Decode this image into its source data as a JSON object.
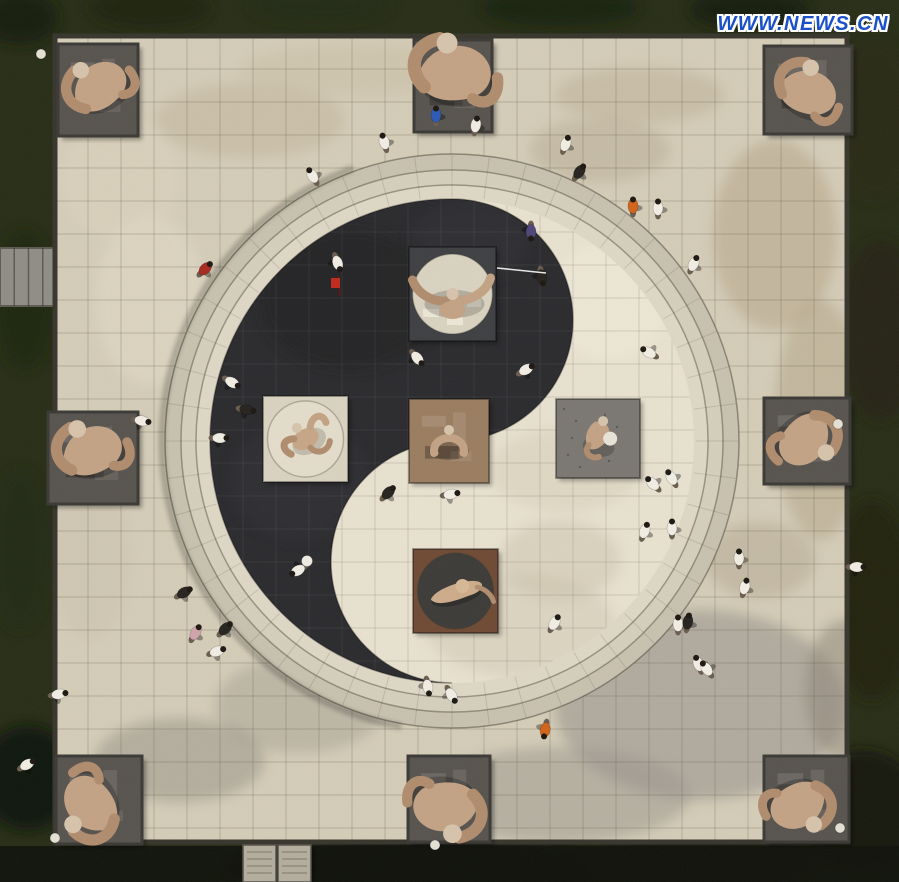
{
  "meta": {
    "description": "Aerial photo of a taiji (yin-yang) sculpture plaza with tai-chi themed stone sculptures and visitors",
    "watermark": "WWW.NEWS.CN"
  },
  "canvas": {
    "width": 899,
    "height": 882
  },
  "palette": {
    "grass_base": "#272d16",
    "grass_bottom": "#0f120a",
    "plaza_base": "#d4ccb7",
    "grid_line": "rgba(95,85,68,0.28)",
    "plaza_frame": "#37352c",
    "ring_outer": "#c8c1af",
    "ring_mid": "#d5cebc",
    "ring_inner": "#ded7c5",
    "yin": "#2a2a2d",
    "yang": "#e8e1cf",
    "base_outer": "#57534e",
    "base_outer_border": "#3b3935",
    "sculpt_tan": "#c3a284",
    "sculpt_tan_dark": "#b08c6d",
    "sculpt_head": "#d6c3ab",
    "path_stone": "#8f8d85",
    "stele_stone": "#b4ad9d",
    "watermark_blue": "#1a51c9",
    "shirts": {
      "white": "#f1ede3",
      "black": "#26231e",
      "blue": "#2d59b5",
      "orange": "#d26318",
      "red": "#a8281e",
      "pink": "#d0a4ab",
      "purple": "#4f4579"
    }
  },
  "scene": {
    "plaza": {
      "x": 55,
      "y": 36,
      "w": 792,
      "h": 806,
      "tile": 33
    },
    "circle": {
      "cx": 452,
      "cy": 441,
      "r_rings": [
        287,
        271,
        256,
        242
      ],
      "r_eye": 121
    },
    "left_path": {
      "x": 0,
      "y": 248,
      "w": 57,
      "h": 58
    },
    "stele": {
      "x": 243,
      "y": 845,
      "w": 68,
      "h": 37
    },
    "grass_blobs": [
      {
        "x": 20,
        "y": 18,
        "rx": 38,
        "ry": 26,
        "c": "#161d0c",
        "o": 0.9
      },
      {
        "x": 150,
        "y": 8,
        "rx": 60,
        "ry": 20,
        "c": "#1a220e",
        "o": 0.8
      },
      {
        "x": 320,
        "y": 6,
        "rx": 70,
        "ry": 16,
        "c": "#202a12",
        "o": 0.8
      },
      {
        "x": 560,
        "y": 8,
        "rx": 80,
        "ry": 18,
        "c": "#18200d",
        "o": 0.85
      },
      {
        "x": 750,
        "y": 10,
        "rx": 60,
        "ry": 20,
        "c": "#141b0a",
        "o": 0.9
      },
      {
        "x": 875,
        "y": 120,
        "rx": 42,
        "ry": 80,
        "c": "#2a2a18",
        "o": 0.8
      },
      {
        "x": 880,
        "y": 330,
        "rx": 38,
        "ry": 90,
        "c": "#262417",
        "o": 0.8
      },
      {
        "x": 872,
        "y": 600,
        "rx": 42,
        "ry": 100,
        "c": "#20200f",
        "o": 0.85
      },
      {
        "x": 862,
        "y": 810,
        "rx": 62,
        "ry": 60,
        "c": "#12150a",
        "o": 0.9
      },
      {
        "x": 25,
        "y": 300,
        "rx": 30,
        "ry": 70,
        "c": "#1e2511",
        "o": 0.8
      },
      {
        "x": 20,
        "y": 550,
        "rx": 30,
        "ry": 80,
        "c": "#222a13",
        "o": 0.8
      },
      {
        "x": 28,
        "y": 778,
        "rx": 48,
        "ry": 52,
        "c": "#0e1208",
        "o": 0.95
      },
      {
        "x": 420,
        "y": 868,
        "rx": 200,
        "ry": 30,
        "c": "#0d1008",
        "o": 0.9
      },
      {
        "x": 700,
        "y": 862,
        "rx": 120,
        "ry": 30,
        "c": "#131608",
        "o": 0.85
      }
    ],
    "patches_plaza": [
      {
        "x": 250,
        "y": 120,
        "rx": 95,
        "ry": 38,
        "c": "#bcae94",
        "o": 0.4
      },
      {
        "x": 600,
        "y": 150,
        "rx": 70,
        "ry": 32,
        "c": "#ab9e85",
        "o": 0.35
      },
      {
        "x": 360,
        "y": 70,
        "rx": 120,
        "ry": 26,
        "c": "#c6bba0",
        "o": 0.4
      },
      {
        "x": 640,
        "y": 95,
        "rx": 85,
        "ry": 28,
        "c": "#b2a489",
        "o": 0.35
      },
      {
        "x": 775,
        "y": 235,
        "rx": 62,
        "ry": 95,
        "c": "#b3a184",
        "o": 0.5
      },
      {
        "x": 820,
        "y": 420,
        "rx": 45,
        "ry": 120,
        "c": "#a89878",
        "o": 0.4
      },
      {
        "x": 700,
        "y": 705,
        "rx": 145,
        "ry": 95,
        "c": "#95908a",
        "o": 0.55
      },
      {
        "x": 560,
        "y": 795,
        "rx": 130,
        "ry": 48,
        "c": "#9a958d",
        "o": 0.5
      },
      {
        "x": 300,
        "y": 705,
        "rx": 85,
        "ry": 48,
        "c": "#a29c91",
        "o": 0.45
      },
      {
        "x": 150,
        "y": 300,
        "rx": 55,
        "ry": 85,
        "c": "#e3dbc7",
        "o": 0.5
      },
      {
        "x": 120,
        "y": 180,
        "rx": 60,
        "ry": 60,
        "c": "#ddd4bf",
        "o": 0.45
      },
      {
        "x": 180,
        "y": 760,
        "rx": 85,
        "ry": 42,
        "c": "#8e8a80",
        "o": 0.45
      },
      {
        "x": 760,
        "y": 560,
        "rx": 55,
        "ry": 38,
        "c": "#ac9f88",
        "o": 0.4
      },
      {
        "x": 845,
        "y": 690,
        "rx": 40,
        "ry": 70,
        "c": "#8b8274",
        "o": 0.5
      },
      {
        "x": 90,
        "y": 560,
        "rx": 40,
        "ry": 80,
        "c": "#c9c0ab",
        "o": 0.4
      }
    ],
    "patches_inner": [
      {
        "x": 565,
        "y": 470,
        "rx": 75,
        "ry": 42,
        "c": "#d9d1bb",
        "o": 0.6
      },
      {
        "x": 520,
        "y": 625,
        "rx": 95,
        "ry": 52,
        "c": "#cfc7b1",
        "o": 0.5
      },
      {
        "x": 610,
        "y": 300,
        "rx": 60,
        "ry": 60,
        "c": "#efe9d8",
        "o": 0.6
      },
      {
        "x": 560,
        "y": 560,
        "rx": 60,
        "ry": 40,
        "c": "#c5bca4",
        "o": 0.4
      }
    ],
    "patches_black": [
      {
        "x": 350,
        "y": 300,
        "rx": 90,
        "ry": 70,
        "c": "#202023",
        "o": 0.6
      },
      {
        "x": 300,
        "y": 480,
        "rx": 70,
        "ry": 60,
        "c": "#333338",
        "o": 0.5
      },
      {
        "x": 470,
        "y": 240,
        "rx": 60,
        "ry": 40,
        "c": "#36363a",
        "o": 0.4
      }
    ],
    "pedestals": [
      {
        "kind": "horns",
        "x": 409,
        "y": 247,
        "w": 87,
        "h": 94,
        "base": "#3e3f42",
        "plate": "#d9d2c0",
        "plate_r": 40,
        "rot": 0
      },
      {
        "kind": "spread",
        "x": 263,
        "y": 396,
        "w": 85,
        "h": 86,
        "base": "#d9d2c0",
        "plate": "#e3dcca",
        "plate_r": 38,
        "rot": -30
      },
      {
        "kind": "arch",
        "x": 409,
        "y": 399,
        "w": 80,
        "h": 84,
        "base": "#9a7d60",
        "rot": 0
      },
      {
        "kind": "stand",
        "x": 556,
        "y": 399,
        "w": 84,
        "h": 79,
        "base": "#7b7772",
        "rot": 10
      },
      {
        "kind": "diver",
        "x": 413,
        "y": 549,
        "w": 85,
        "h": 84,
        "base": "#6f4a34",
        "plate": "#3c3b38",
        "plate_r": 38,
        "rot": -15
      }
    ],
    "outer_sculptures": [
      {
        "x": 58,
        "y": 44,
        "w": 80,
        "h": 92,
        "fx": 98,
        "fy": 88,
        "rot": -30,
        "s": 1.5
      },
      {
        "x": 414,
        "y": 40,
        "w": 78,
        "h": 92,
        "fx": 452,
        "fy": 74,
        "rot": 5,
        "s": 1.9
      },
      {
        "x": 764,
        "y": 46,
        "w": 88,
        "h": 88,
        "fx": 806,
        "fy": 92,
        "rot": 25,
        "s": 1.5
      },
      {
        "x": 48,
        "y": 412,
        "w": 90,
        "h": 92,
        "fx": 90,
        "fy": 452,
        "rot": -15,
        "s": 1.6
      },
      {
        "x": 764,
        "y": 398,
        "w": 86,
        "h": 86,
        "fx": 806,
        "fy": 438,
        "rot": 140,
        "s": 1.5
      },
      {
        "x": 56,
        "y": 756,
        "w": 86,
        "h": 88,
        "fx": 92,
        "fy": 806,
        "rot": -120,
        "s": 1.6
      },
      {
        "x": 408,
        "y": 756,
        "w": 82,
        "h": 86,
        "fx": 448,
        "fy": 806,
        "rot": 185,
        "s": 1.7
      },
      {
        "x": 764,
        "y": 756,
        "w": 85,
        "h": 86,
        "fx": 800,
        "fy": 804,
        "rot": 160,
        "s": 1.5
      }
    ],
    "people": [
      {
        "x": 312,
        "y": 175,
        "c": "white",
        "r": -30
      },
      {
        "x": 384,
        "y": 141,
        "c": "white",
        "r": -15
      },
      {
        "x": 436,
        "y": 114,
        "c": "blue",
        "r": 0
      },
      {
        "x": 476,
        "y": 124,
        "c": "white",
        "r": 10
      },
      {
        "x": 566,
        "y": 143,
        "c": "white",
        "r": 20
      },
      {
        "x": 580,
        "y": 171,
        "c": "black",
        "r": 35
      },
      {
        "x": 633,
        "y": 205,
        "c": "orange",
        "r": 0
      },
      {
        "x": 658,
        "y": 207,
        "c": "white",
        "r": 0
      },
      {
        "x": 694,
        "y": 263,
        "c": "white",
        "r": 25
      },
      {
        "x": 206,
        "y": 268,
        "c": "red",
        "r": 45
      },
      {
        "x": 338,
        "y": 264,
        "c": "white",
        "r": 160
      },
      {
        "x": 531,
        "y": 233,
        "c": "purple",
        "r": 180
      },
      {
        "x": 542,
        "y": 278,
        "c": "black",
        "r": 170
      },
      {
        "x": 418,
        "y": 359,
        "c": "white",
        "r": 140
      },
      {
        "x": 527,
        "y": 369,
        "c": "white",
        "r": 60
      },
      {
        "x": 233,
        "y": 383,
        "c": "white",
        "r": 120
      },
      {
        "x": 248,
        "y": 410,
        "c": "black",
        "r": 100
      },
      {
        "x": 221,
        "y": 438,
        "c": "white",
        "r": 90
      },
      {
        "x": 389,
        "y": 492,
        "c": "black",
        "r": 45
      },
      {
        "x": 452,
        "y": 494,
        "c": "white",
        "r": 80
      },
      {
        "x": 297,
        "y": 571,
        "c": "white",
        "r": -120
      },
      {
        "x": 648,
        "y": 352,
        "c": "white",
        "r": -60
      },
      {
        "x": 671,
        "y": 477,
        "c": "white",
        "r": -30
      },
      {
        "x": 652,
        "y": 483,
        "c": "white",
        "r": -45
      },
      {
        "x": 672,
        "y": 527,
        "c": "white",
        "r": 0
      },
      {
        "x": 645,
        "y": 530,
        "c": "white",
        "r": 20
      },
      {
        "x": 428,
        "y": 688,
        "c": "white",
        "r": 170
      },
      {
        "x": 452,
        "y": 696,
        "c": "white",
        "r": 150
      },
      {
        "x": 555,
        "y": 622,
        "c": "white",
        "r": 30
      },
      {
        "x": 185,
        "y": 592,
        "c": "black",
        "r": 60
      },
      {
        "x": 196,
        "y": 632,
        "c": "pink",
        "r": 30
      },
      {
        "x": 226,
        "y": 628,
        "c": "black",
        "r": 45
      },
      {
        "x": 218,
        "y": 651,
        "c": "white",
        "r": 70
      },
      {
        "x": 678,
        "y": 623,
        "c": "white",
        "r": 0
      },
      {
        "x": 688,
        "y": 621,
        "c": "black",
        "r": 10
      },
      {
        "x": 698,
        "y": 663,
        "c": "white",
        "r": -20
      },
      {
        "x": 706,
        "y": 668,
        "c": "white",
        "r": -35
      },
      {
        "x": 545,
        "y": 731,
        "c": "orange",
        "r": 190
      },
      {
        "x": 739,
        "y": 557,
        "c": "white",
        "r": 0
      },
      {
        "x": 745,
        "y": 586,
        "c": "white",
        "r": 15
      },
      {
        "x": 858,
        "y": 567,
        "c": "white",
        "r": 90
      },
      {
        "x": 143,
        "y": 421,
        "c": "white",
        "r": 100
      },
      {
        "x": 60,
        "y": 694,
        "c": "white",
        "r": 80
      },
      {
        "x": 28,
        "y": 764,
        "c": "white",
        "r": 60
      }
    ],
    "props": [
      {
        "type": "flag",
        "x": 336,
        "y": 282
      },
      {
        "type": "sword",
        "x1": 497,
        "y1": 268,
        "x2": 546,
        "y2": 273
      },
      {
        "type": "fan",
        "x": 307,
        "y": 561
      },
      {
        "type": "ball",
        "x": 41,
        "y": 54
      },
      {
        "type": "ball",
        "x": 838,
        "y": 424
      },
      {
        "type": "ball",
        "x": 840,
        "y": 828
      },
      {
        "type": "ball",
        "x": 55,
        "y": 838
      },
      {
        "type": "ball",
        "x": 435,
        "y": 845
      }
    ]
  }
}
